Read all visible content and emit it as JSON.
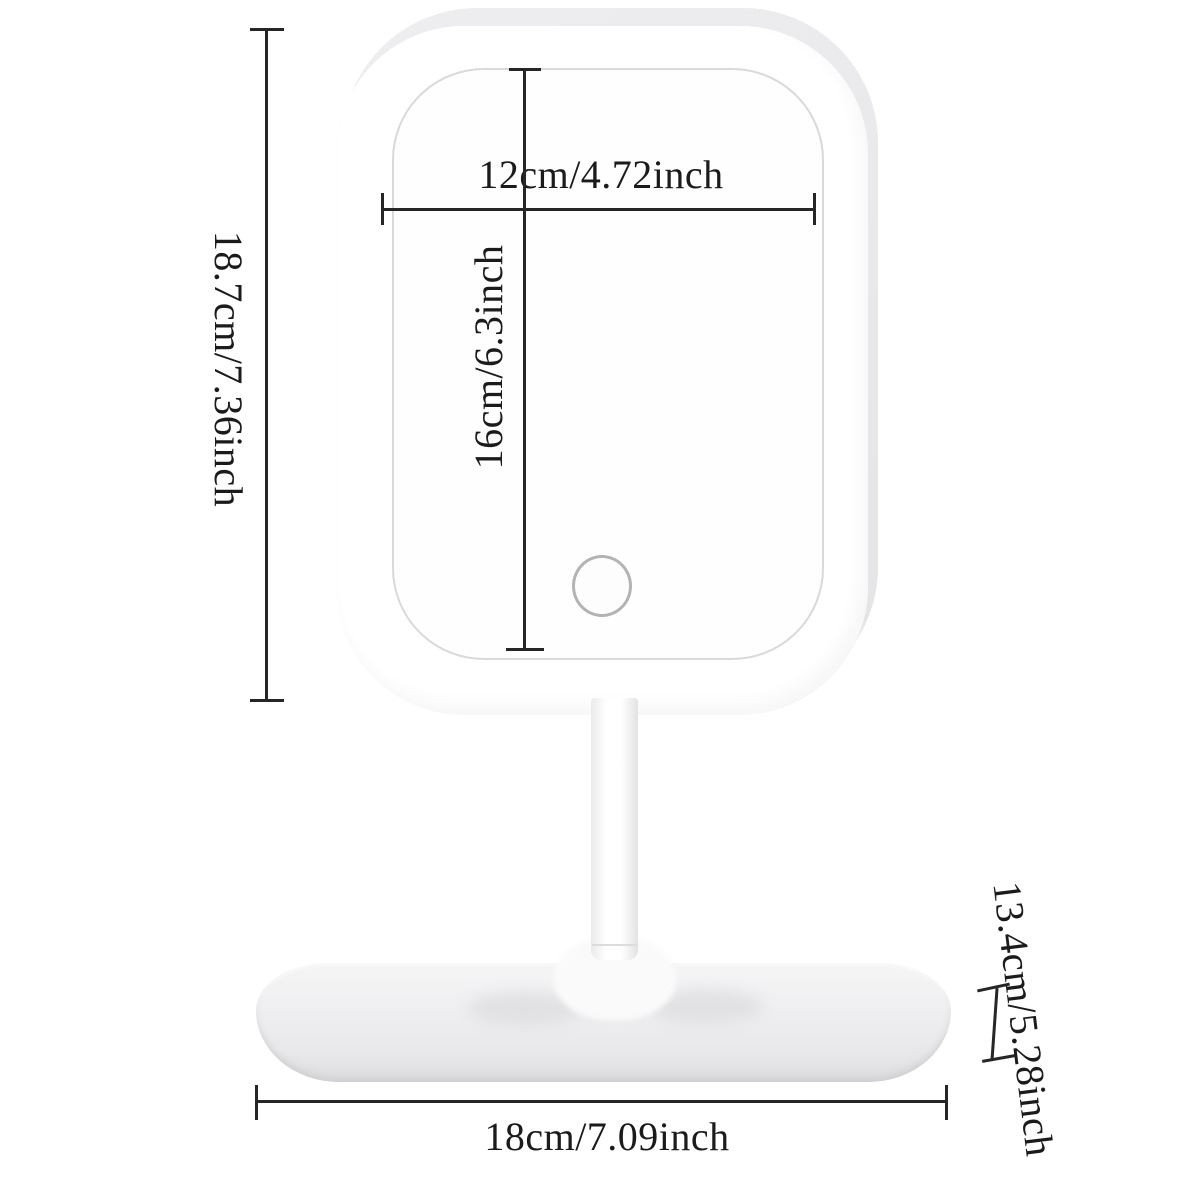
{
  "diagram": {
    "title": "LED vanity mirror dimension diagram",
    "background_color": "#ffffff",
    "line_color": "#262626",
    "text_color": "#1b1b1b"
  },
  "product": {
    "frame_color": "#ffffff",
    "shell_color": "#e9e9eb",
    "base_color": "#ededef",
    "touch_button_ring_color": "#b3b3b5",
    "parts": {
      "mirror_frame": "rounded-rectangle mirror frame",
      "mirror_glass": "mirror surface",
      "touch_button": "touch control button",
      "stand_neck": "stand neck",
      "base_tray": "storage base tray"
    }
  },
  "dimensions": {
    "frame_height": {
      "label": "18.7cm/7.36inch",
      "cm": 18.7,
      "inch": 7.36
    },
    "glass_width": {
      "label": "12cm/4.72inch",
      "cm": 12,
      "inch": 4.72
    },
    "glass_height": {
      "label": "16cm/6.3inch",
      "cm": 16,
      "inch": 6.3
    },
    "base_depth": {
      "label": "13.4cm/5.28inch",
      "cm": 13.4,
      "inch": 5.28
    },
    "base_width": {
      "label": "18cm/7.09inch",
      "cm": 18,
      "inch": 7.09
    }
  }
}
